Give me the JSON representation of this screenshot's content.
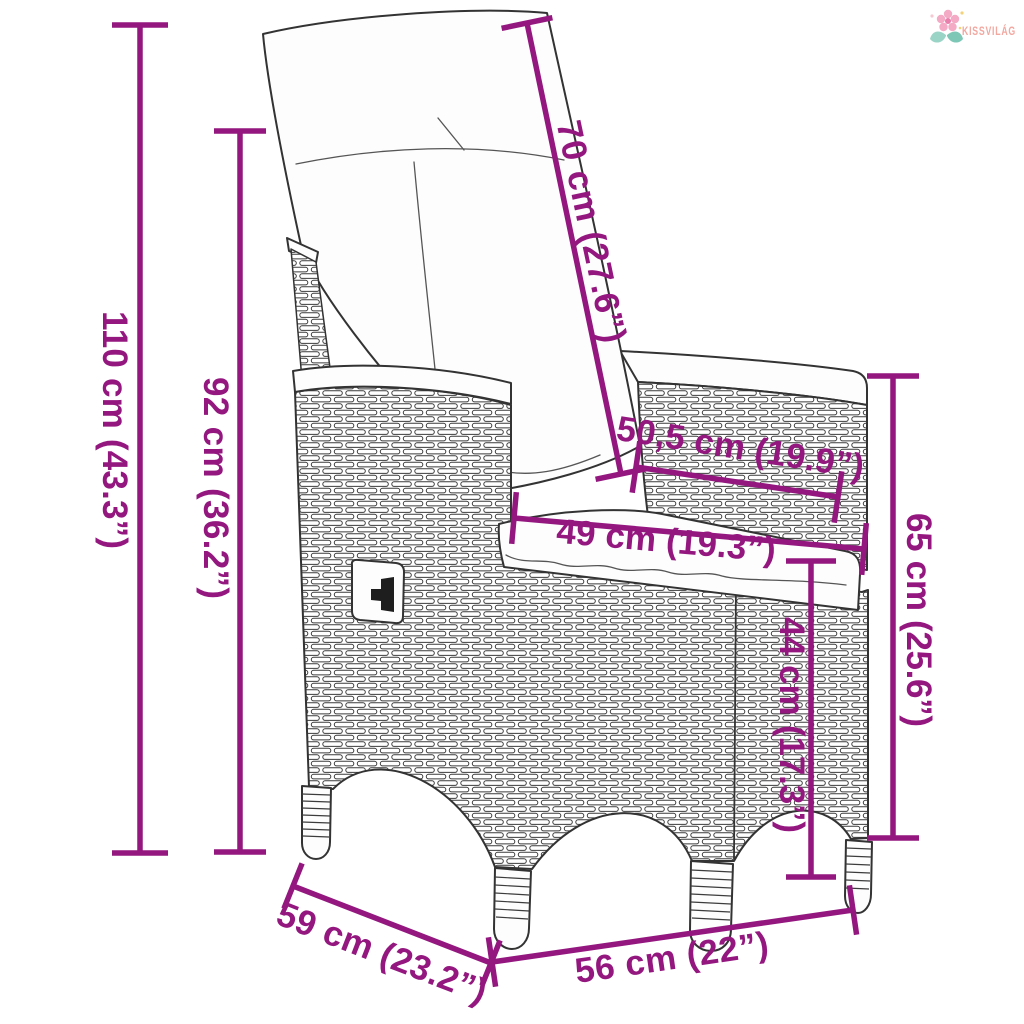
{
  "brand": {
    "name": "KISSVILÁG"
  },
  "colors": {
    "dimension_accent": "#93177F",
    "logo_text": "#F2A79F",
    "line_art": "#333333"
  },
  "diagram": {
    "subject": "reclining-garden-chair-line-art"
  },
  "dimensions": {
    "total_height": "110 cm (43.3”)",
    "backrest_height": "92 cm (36.2”)",
    "backrest_length": "70 cm (27.6”)",
    "armrest_length": "50,5 cm (19.9”)",
    "seat_width": "49 cm (19.3”)",
    "armrest_height": "65 cm (25.6”)",
    "seat_height": "44 cm (17.3”)",
    "seat_depth": "59 cm (23.2”)",
    "front_width": "56 cm (22”)"
  }
}
